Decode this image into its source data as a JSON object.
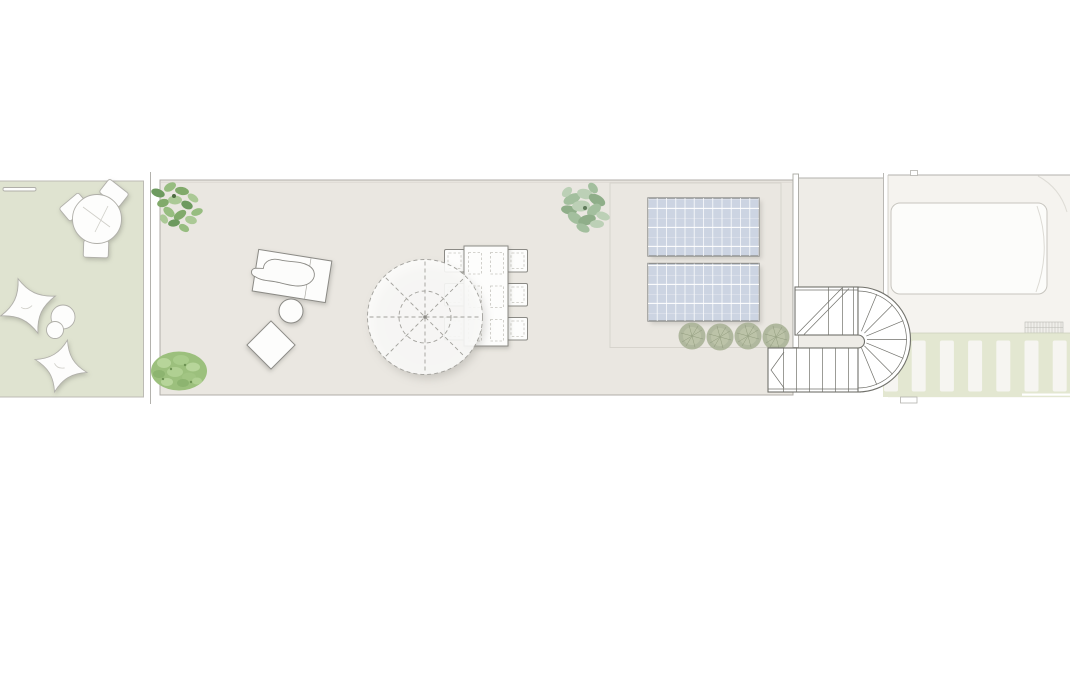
{
  "document": {
    "type": "roof-terrace-floor-plan",
    "background": "#ffffff"
  },
  "colors": {
    "garden": "#dfe3d0",
    "terrace": "#eae7e1",
    "room": "#eeece7",
    "patio": "#f5f3ef",
    "deck": "#e3e7d1",
    "solar_panel": "#ccd4e2",
    "panel_grid": "#ffffff",
    "outline": "#b3b2ad",
    "furniture_outline": "#8b8a85",
    "stair_outline": "#71716b",
    "white_fill": "#fdfdfc",
    "plant_dark": "#6d9a5f",
    "plant_mid": "#96bd79",
    "plant_sage": "#a3bf9e",
    "shrub": "#aab297"
  },
  "inventory": {
    "garden_lounge": {
      "round_table": 1,
      "chairs": 3,
      "bean_bags": 2,
      "poufs": 2,
      "bench": 1
    },
    "terrace": {
      "sun_lounger": 1,
      "side_table": 1,
      "floor_cushion": 1,
      "parasol": 1,
      "dining_table": 1,
      "dining_chairs": 6,
      "solar_panels": 2,
      "plants": 3,
      "hedge_shrubs": 4
    },
    "stair": {
      "flights": 2,
      "turn": "semicircular",
      "direction_arrow": 1
    },
    "deck": {
      "slats": 7
    },
    "patio": {
      "skylight_roof": 1,
      "vent_grate": 1
    }
  }
}
